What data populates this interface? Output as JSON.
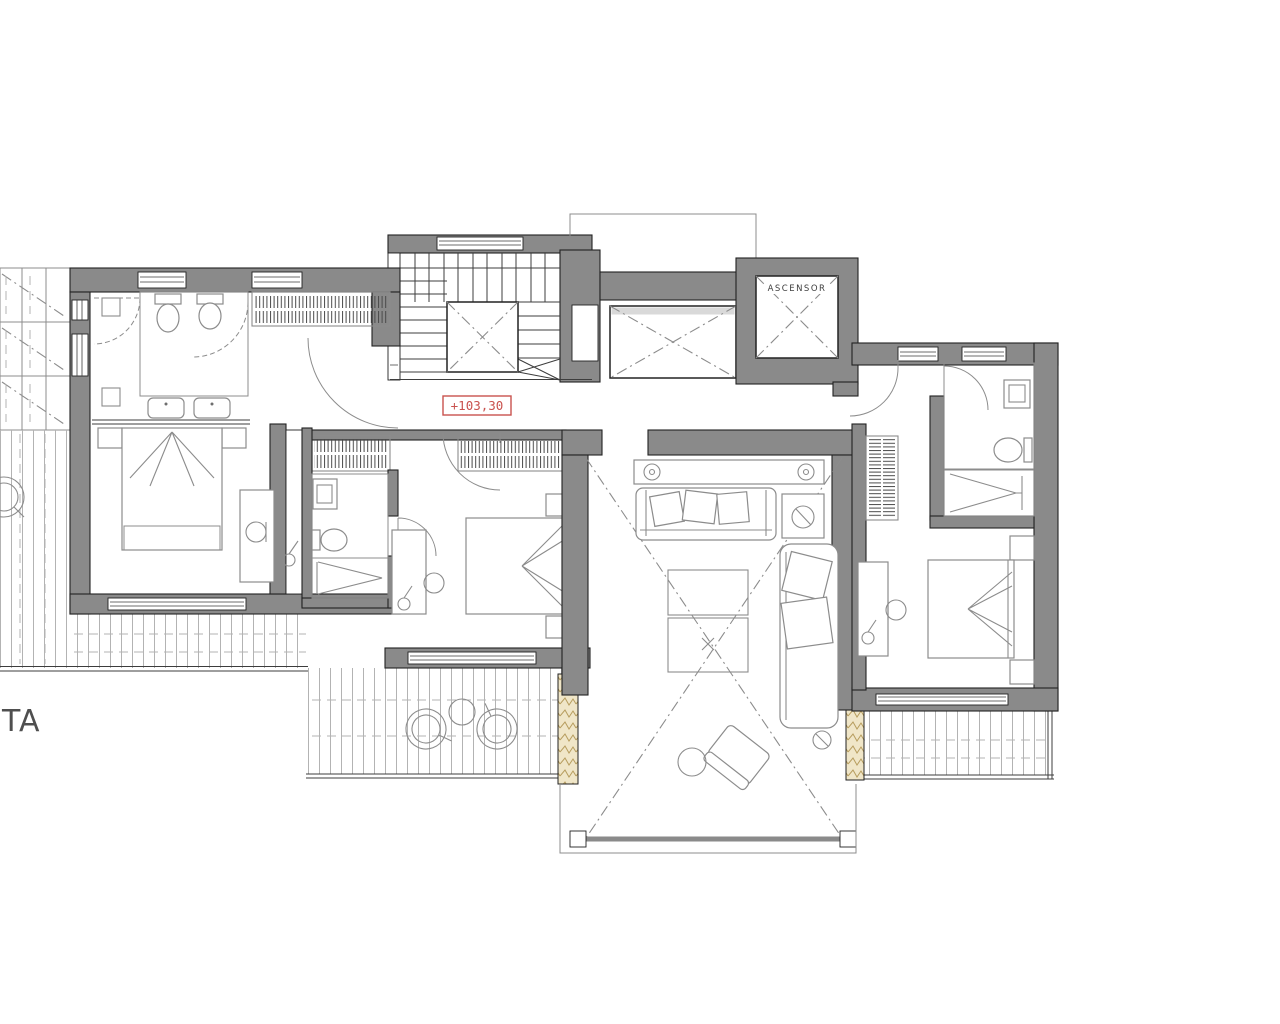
{
  "labels": {
    "elevator": "ASCENSOR",
    "elevation": "+103,30",
    "title_partial": "TA"
  },
  "colors": {
    "wall_fill": "#8a8a8a",
    "wall_edge": "#222222",
    "line_dark": "#3d3d3d",
    "line_mid": "#8c8c8c",
    "line_light": "#b3b3b3",
    "red": "#c9524e",
    "stone_fill": "#f0e6c8",
    "stone_edge": "#b79d5e",
    "text_gray": "#4f4f4f",
    "bg": "#ffffff"
  }
}
